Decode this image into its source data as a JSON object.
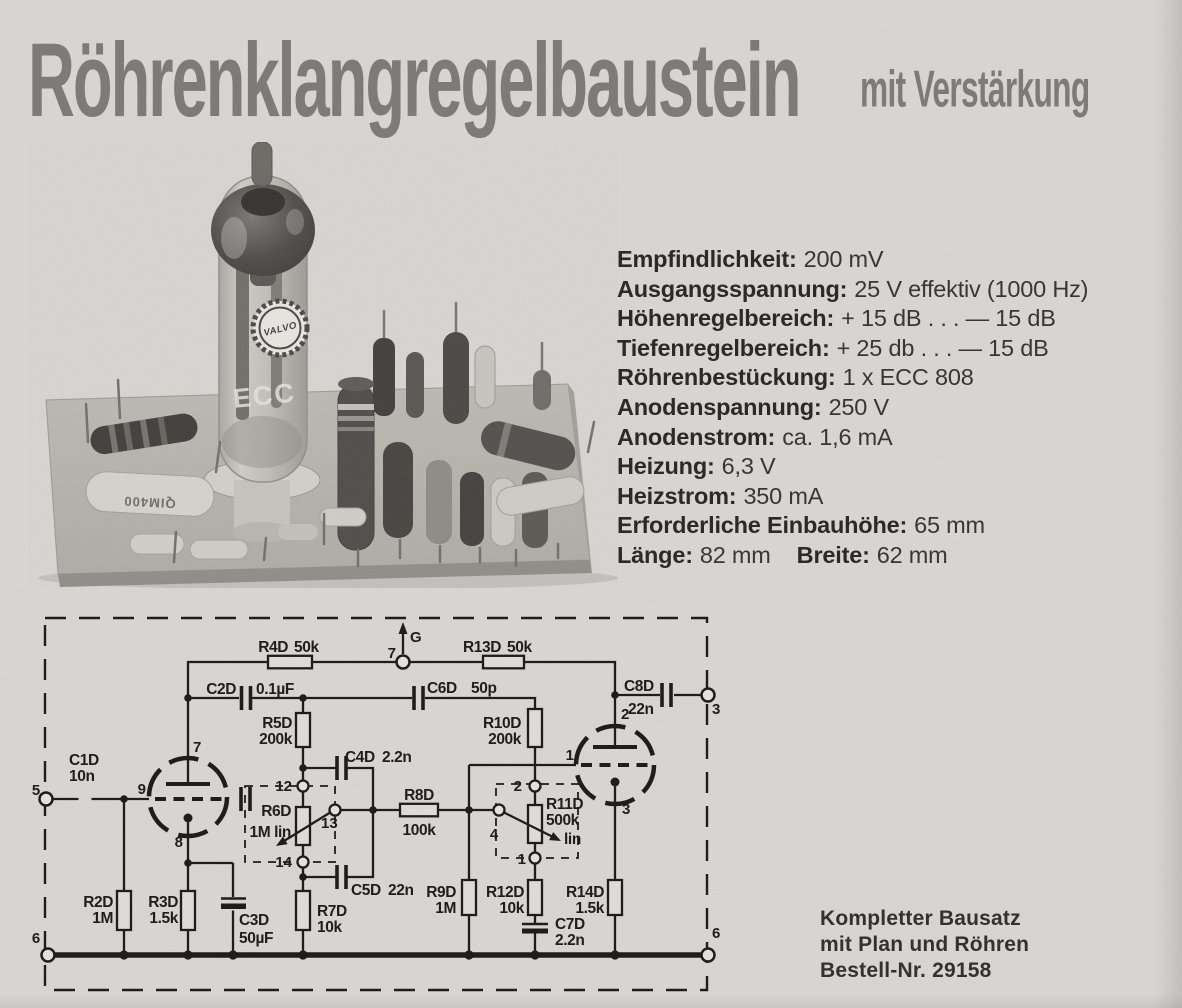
{
  "colors": {
    "paper": "#d8d6d2",
    "ink": "#191815",
    "title_gray": "#7b7976",
    "photo_dark": "#45433f"
  },
  "header": {
    "title": "Röhrenklangregelbaustein",
    "subtitle": "mit Verstärkung"
  },
  "specs": {
    "rows": [
      [
        {
          "label": "Empfindlichkeit:",
          "value": "200 mV"
        }
      ],
      [
        {
          "label": "Ausgangsspannung:",
          "value": "25 V effektiv (1000 Hz)"
        }
      ],
      [
        {
          "label": "Höhenregelbereich:",
          "value": "+ 15 dB . . . — 15 dB"
        }
      ],
      [
        {
          "label": "Tiefenregelbereich:",
          "value": "+ 25 db . . . — 15 dB"
        }
      ],
      [
        {
          "label": "Röhrenbestückung:",
          "value": "1 x ECC 808"
        }
      ],
      [
        {
          "label": "Anodenspannung:",
          "value": "250 V"
        }
      ],
      [
        {
          "label": "Anodenstrom:",
          "value": "ca. 1,6 mA"
        }
      ],
      [
        {
          "label": "Heizung:",
          "value": "6,3 V"
        }
      ],
      [
        {
          "label": "Heizstrom:",
          "value": "350 mA"
        }
      ],
      [
        {
          "label": "Erforderliche Einbauhöhe:",
          "value": "65 mm"
        }
      ],
      [
        {
          "label": "Länge:",
          "value": "82 mm"
        },
        {
          "label": "Breite:",
          "value": "62 mm"
        }
      ]
    ]
  },
  "photo": {
    "logo": "VALVO",
    "tube_marking": "ECC",
    "cap_marking": "QIM400"
  },
  "schematic": {
    "terminals": {
      "input": "5",
      "ground_left": "6",
      "supply": "7",
      "supply_rail": "G",
      "output": "3",
      "ground_right": "6"
    },
    "tube1_pins": {
      "anode": "7",
      "grid": "9",
      "cathode": "8"
    },
    "tube2_pins": {
      "anode": "2",
      "grid": "1",
      "cathode": "3"
    },
    "pot1_pins": {
      "top": "12",
      "wiper": "13",
      "bottom": "14"
    },
    "pot2_pins": {
      "top": "2",
      "wiper": "4",
      "bottom": "1"
    },
    "components": {
      "c1d": {
        "ref": "C1D",
        "value": "10n"
      },
      "c2d": {
        "ref": "C2D",
        "value": "0.1µF"
      },
      "c3d": {
        "ref": "C3D",
        "value": "50µF"
      },
      "c4d": {
        "ref": "C4D",
        "value": "2.2n"
      },
      "c5d": {
        "ref": "C5D",
        "value": "22n"
      },
      "c6d": {
        "ref": "C6D",
        "value": "50p"
      },
      "c7d": {
        "ref": "C7D",
        "value": "2.2n"
      },
      "c8d": {
        "ref": "C8D",
        "value": "22n"
      },
      "r2d": {
        "ref": "R2D",
        "value": "1M"
      },
      "r3d": {
        "ref": "R3D",
        "value": "1.5k"
      },
      "r4d": {
        "ref": "R4D",
        "value": "50k"
      },
      "r5d": {
        "ref": "R5D",
        "value": "200k"
      },
      "r6d": {
        "ref": "R6D",
        "value": "1M lin"
      },
      "r7d": {
        "ref": "R7D",
        "value": "10k"
      },
      "r8d": {
        "ref": "R8D",
        "value": "100k"
      },
      "r9d": {
        "ref": "R9D",
        "value": "1M"
      },
      "r10d": {
        "ref": "R10D",
        "value": "200k"
      },
      "r11d": {
        "ref": "R11D",
        "value": "500k",
        "taper": "lin"
      },
      "r12d": {
        "ref": "R12D",
        "value": "10k"
      },
      "r13d": {
        "ref": "R13D",
        "value": "50k"
      },
      "r14d": {
        "ref": "R14D",
        "value": "1.5k"
      }
    }
  },
  "order": {
    "lines": [
      "Kompletter Bausatz",
      "mit Plan und Röhren",
      "Bestell-Nr. 29158"
    ]
  }
}
